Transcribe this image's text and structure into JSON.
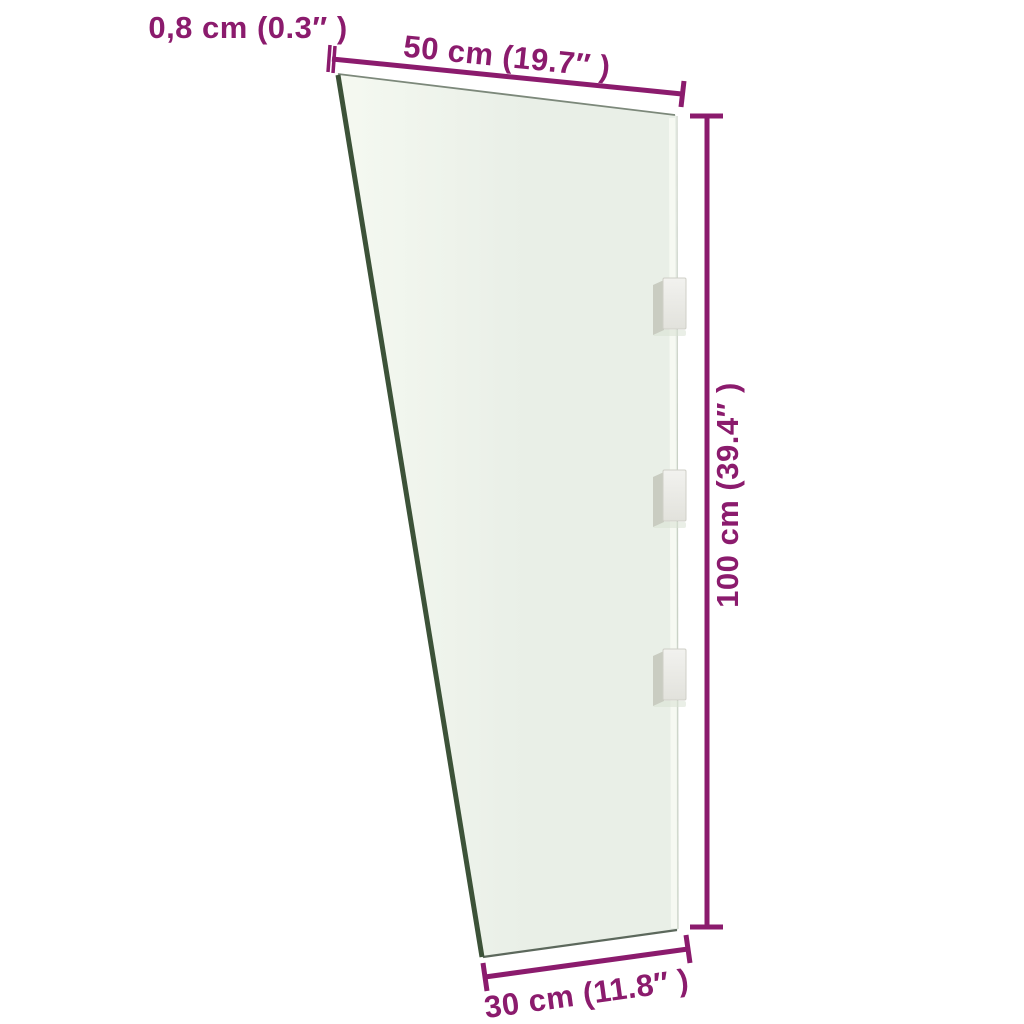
{
  "colors": {
    "background": "#ffffff",
    "accent": "#8b1b6d",
    "glass_light": "#f5f9f1",
    "glass_dark": "#e9efe7",
    "glass_edge_dark": "#3c5238",
    "glass_edge_thin": "#7c887a",
    "glass_edge_bottom": "#5c685c",
    "glass_highlight": "#f6f9f2",
    "glass_edge_faint": "#c9d1c5",
    "bracket_face_light": "#f2f2ef",
    "bracket_face_dark": "#e2e2dc",
    "bracket_border": "#cfcfc7",
    "bracket_side": "#c9ccc1",
    "bracket_shadow": "#d8e2d3"
  },
  "labels": {
    "thickness": "0,8 cm (0.3″ )",
    "top_width": "50 cm (19.7″ )",
    "height": "100 cm (39.4″ )",
    "bottom_width": "30 cm (11.8″ )"
  }
}
